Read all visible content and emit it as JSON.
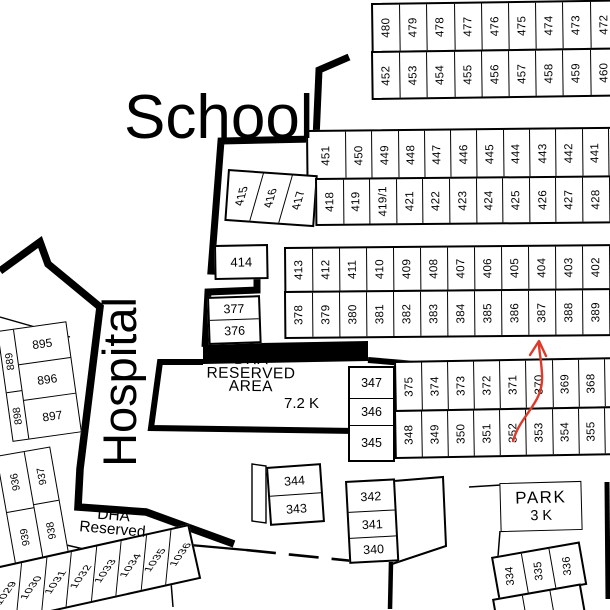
{
  "labels": {
    "school": "School",
    "hospital": "Hospital",
    "dha_area_line1": "DHA",
    "dha_area_line2": "RESERVED",
    "dha_area_line3": "AREA",
    "dha_area_size": "7.2 K",
    "dha_reserved_line1": "DHA",
    "dha_reserved_line2": "Reserved",
    "park": "PARK",
    "park_size": "3 K"
  },
  "plots": {
    "block_a_row1": [
      "480",
      "479",
      "478",
      "477",
      "476",
      "475",
      "474",
      "473",
      "472"
    ],
    "block_a_row2": [
      "452",
      "453",
      "454",
      "455",
      "456",
      "457",
      "458",
      "459",
      "460"
    ],
    "block_b_row1": [
      "451",
      "450",
      "449",
      "448",
      "447",
      "446",
      "445",
      "444",
      "443",
      "442",
      "441"
    ],
    "block_b_row2_left": [
      "415",
      "416",
      "417"
    ],
    "block_b_row2": [
      "418",
      "419",
      "419/1",
      "421",
      "422",
      "423",
      "424",
      "425",
      "426",
      "427",
      "428"
    ],
    "plot_414": "414",
    "block_c_row1": [
      "413",
      "412",
      "411",
      "410",
      "409",
      "408",
      "407",
      "406",
      "405",
      "404",
      "403",
      "402"
    ],
    "block_c_row2": [
      "378",
      "379",
      "380",
      "381",
      "382",
      "383",
      "384",
      "385",
      "386",
      "387",
      "388",
      "389"
    ],
    "plot_377": "377",
    "plot_376": "376",
    "block_d_col": [
      "347",
      "346",
      "345"
    ],
    "block_d_row1": [
      "375",
      "374",
      "373",
      "372",
      "371",
      "370",
      "369",
      "368"
    ],
    "block_d_row2": [
      "348",
      "349",
      "350",
      "351",
      "352",
      "353",
      "354",
      "355"
    ],
    "block_344": [
      "344",
      "343"
    ],
    "block_342": [
      "342",
      "341",
      "340"
    ],
    "block_334": [
      "334",
      "335",
      "336"
    ],
    "block_895": [
      "895",
      "896",
      "897"
    ],
    "block_895_left": [
      "889",
      "898"
    ],
    "block_936_left": [
      "936",
      "939"
    ],
    "block_936_right": [
      "937",
      "938"
    ],
    "block_1030": [
      "1029",
      "1030",
      "1031",
      "1032",
      "1033",
      "1034",
      "1035",
      "1036"
    ]
  },
  "annotation": {
    "arrow_points_to_plot": "387"
  },
  "colors": {
    "ink": "#000000",
    "background": "#ffffff",
    "arrow": "#dd3a2b"
  }
}
